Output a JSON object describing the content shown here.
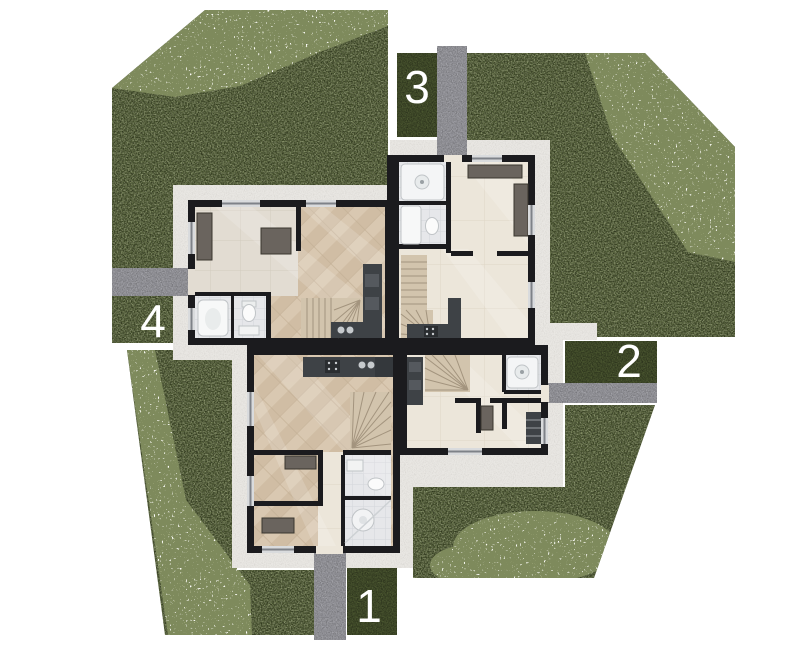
{
  "site_plan": {
    "units": [
      {
        "id": "unit-1",
        "label": "1"
      },
      {
        "id": "unit-2",
        "label": "2"
      },
      {
        "id": "unit-3",
        "label": "3"
      },
      {
        "id": "unit-4",
        "label": "4"
      }
    ],
    "colors": {
      "background": "#ffffff",
      "lawn_green": "#4c5831",
      "flower_bed": "#e8ecdc",
      "footpath_light": "#e9e7e3",
      "walkway_gray": "#a2a2a8",
      "building_wall": "#1b1b1e",
      "wood_floor": "#d6c5ae",
      "tile_floor": "#ece6da",
      "bathroom_tile": "#e6e7ea",
      "kitchen_counter": "#3e4246",
      "unit_label_text": "#ffffff"
    }
  }
}
